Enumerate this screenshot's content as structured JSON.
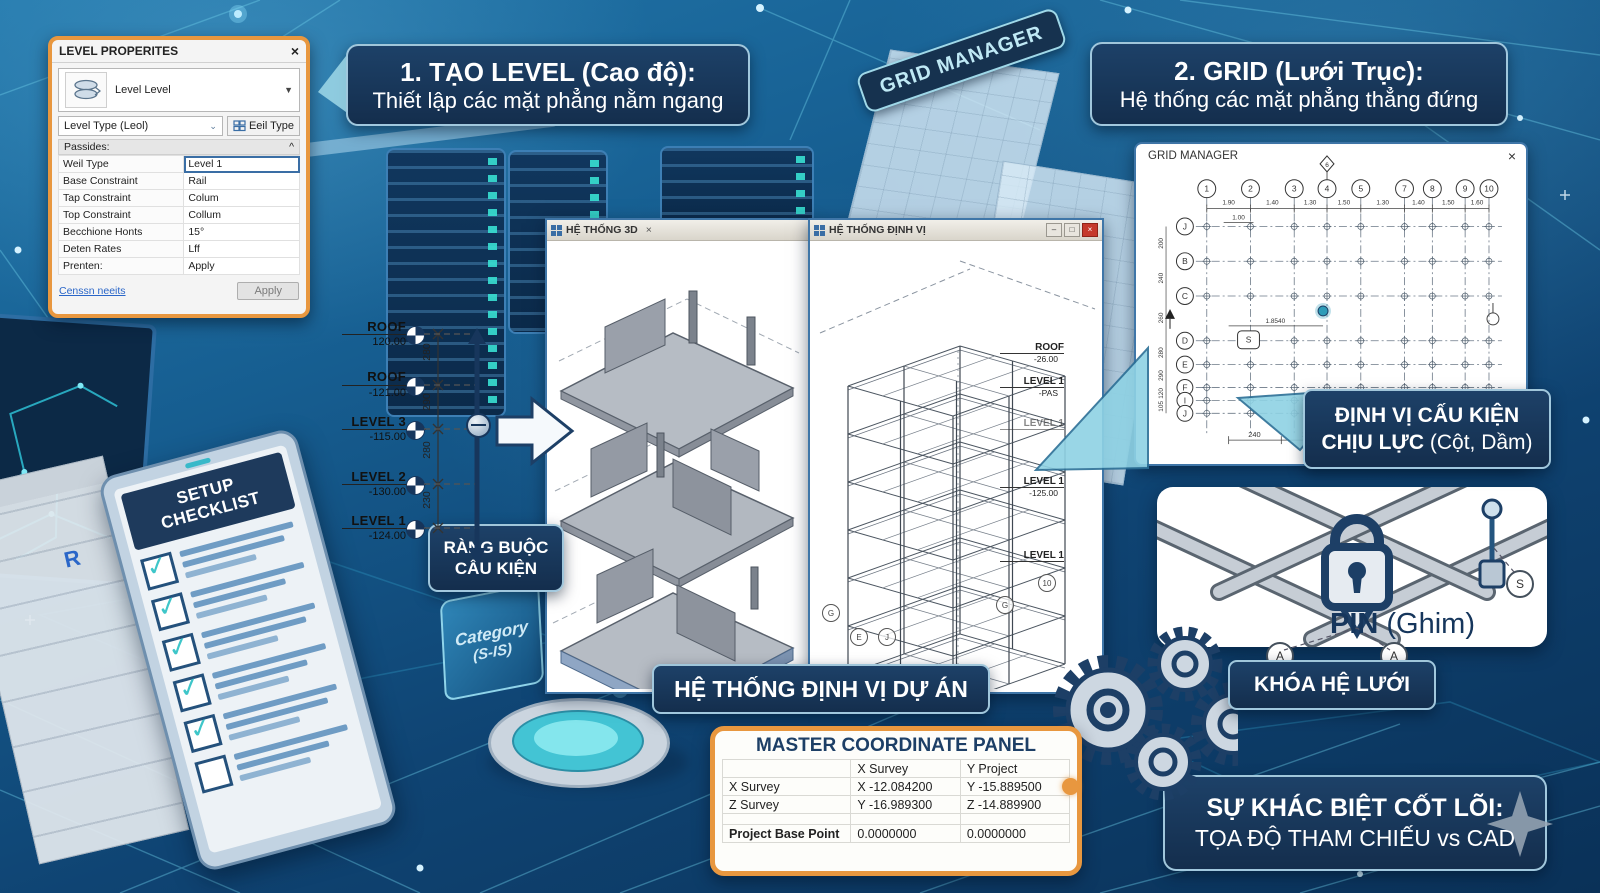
{
  "dialog": {
    "title": "LEVEL PROPERITES",
    "close": "×",
    "type_selector": "Level Level",
    "type_dropdown": "Level Type (Leol)",
    "edit_type_button": "Eeil Type",
    "section_header": "Passides:",
    "collapse": "^",
    "rows": [
      {
        "label": "Weil Type",
        "value": "Level 1"
      },
      {
        "label": "Base Constraint",
        "value": "Rail"
      },
      {
        "label": "Tap Constraint",
        "value": "Colum"
      },
      {
        "label": "Top Constraint",
        "value": "Collum"
      },
      {
        "label": "Becchione Honts",
        "value": "15°"
      },
      {
        "label": "Deten Rates",
        "value": "Lff"
      },
      {
        "label": "Prenten:",
        "value": "Apply"
      }
    ],
    "link": "Censsn neeits",
    "apply_button": "Apply"
  },
  "banner_level": {
    "title": "1. TẠO LEVEL (Cao độ):",
    "subtitle": "Thiết lập các mặt phẳng nằm ngang"
  },
  "banner_grid": {
    "title": "2. GRID (Lưới Trục):",
    "subtitle": "Hệ thống các mặt phẳng thẳng đứng"
  },
  "grid_tag": "GRID MANAGER",
  "levels": {
    "markers": [
      {
        "name": "ROOF",
        "elevation": "120.00"
      },
      {
        "name": "ROOF",
        "elevation": "-121.00"
      },
      {
        "name": "LEVEL 3",
        "elevation": "-115.00"
      },
      {
        "name": "LEVEL 2",
        "elevation": "-130.00"
      },
      {
        "name": "LEVEL 1",
        "elevation": "-124.00"
      }
    ],
    "spacings": [
      "280",
      "290",
      "280",
      "230"
    ]
  },
  "viewer3d": {
    "tab": "HỆ THỐNG 3D",
    "close": "×"
  },
  "viewerwf": {
    "title": "HỆ THỐNG ĐỊNH VỊ",
    "min": "–",
    "max": "□",
    "close": "×",
    "levels": [
      {
        "name": "ROOF",
        "elevation": "-26.00"
      },
      {
        "name": "LEVEL 1",
        "elevation": "-PAS"
      },
      {
        "name": "LEVEL 1",
        "elevation": ""
      },
      {
        "name": "LEVEL 1",
        "elevation": "-125.00"
      },
      {
        "name": "LEVEL 1",
        "elevation": ""
      }
    ],
    "bubbles": [
      "G",
      "E",
      "J",
      "G",
      "10"
    ]
  },
  "rangbuoc": {
    "line1": "RÀNG BUỘC",
    "line2": "CẤU KIỆN"
  },
  "category": {
    "line1": "Category",
    "line2": "(S-IS)"
  },
  "checklist": {
    "title": "SETUP CHECKLIST",
    "check": "✓"
  },
  "r_logo": "R",
  "project_banner": "HỆ THỐNG ĐỊNH VỊ DỰ ÁN",
  "coord": {
    "title": "MASTER COORDINATE PANEL",
    "headers": [
      "X Survey",
      "Y Project"
    ],
    "rows": [
      [
        "X Survey",
        "X -12.084200",
        "Y -15.889500"
      ],
      [
        "Z Survey",
        "Y -16.989300",
        "Z -14.889900"
      ],
      [
        "Project Base Point",
        "0.0000000",
        "0.0000000"
      ]
    ]
  },
  "gridwin": {
    "title": "GRID MANAGER",
    "close": "×",
    "top_bubbles": [
      "1",
      "2",
      "3",
      "4",
      "5",
      "7",
      "8",
      "9",
      "10"
    ],
    "top_dims": [
      "1.90",
      "1.40",
      "1.30",
      "1.50",
      "1.30",
      "1.40",
      "1.50",
      "1.60"
    ],
    "sub_dim": "1.00",
    "diamond_bubble": "6",
    "side_bubbles": [
      "J",
      "B",
      "C",
      "D",
      "E",
      "F",
      "I",
      "J"
    ],
    "side_dims": [
      "200",
      "240",
      "260",
      "280",
      "290",
      "120",
      "105"
    ],
    "plan_dim": "1.8540",
    "s_label": "S",
    "bottom_dims": [
      "240",
      "240"
    ]
  },
  "callout": {
    "line1": "ĐỊNH VỊ CẤU KIỆN",
    "line2_bold": "CHỊU LỰC",
    "line2_rest": " (Cột, Dầm)"
  },
  "pin": {
    "bold": "PIN",
    "rest": " (Ghim)",
    "bubbles": [
      "A",
      "A",
      "S"
    ]
  },
  "khoa": "KHÓA HỆ LƯỚI",
  "core": {
    "line1": "SỰ KHÁC BIỆT CỐT LÕI:",
    "line2": "TỌA ĐỘ THAM CHIẾU vs CAD"
  }
}
